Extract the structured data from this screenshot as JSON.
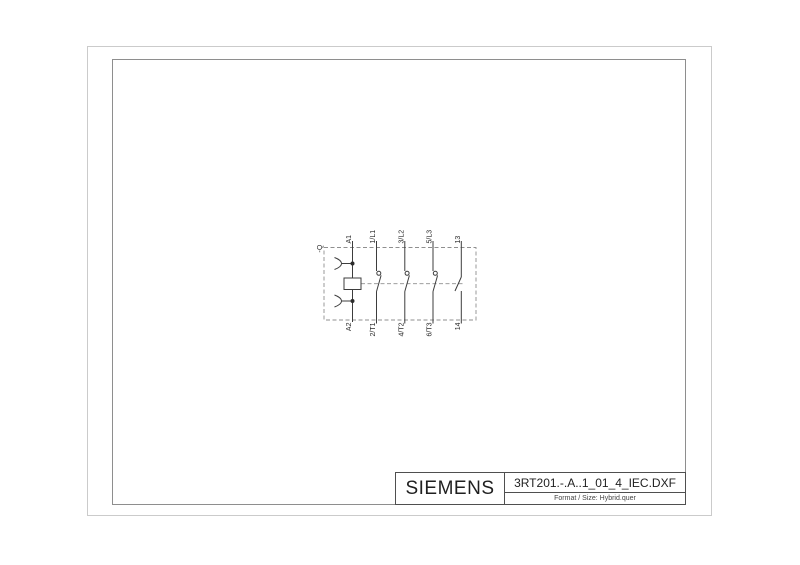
{
  "title_block": {
    "brand": "SIEMENS",
    "filename": "3RT201.-.A..1_01_4_IEC.DXF",
    "format_line": "Format / Size: Hybrid.quer"
  },
  "schematic": {
    "device_tag": "-Q",
    "coil": {
      "top_terminal": "A1",
      "bottom_terminal": "A2"
    },
    "poles": [
      {
        "top": "1/L1",
        "bottom": "2/T1",
        "type": "main"
      },
      {
        "top": "3/L2",
        "bottom": "4/T2",
        "type": "main"
      },
      {
        "top": "5/L3",
        "bottom": "6/T3",
        "type": "main"
      },
      {
        "top": "13",
        "bottom": "14",
        "type": "auxiliary"
      }
    ],
    "colors": {
      "solid_line": "#3d3d3d",
      "dashed_line": "#8f8f8f",
      "text": "#2a2a2a"
    }
  },
  "frame": {
    "outer_border_color": "#cbcbcb",
    "inner_border_color": "#8e8e8e",
    "title_border_color": "#4f4f4f"
  }
}
